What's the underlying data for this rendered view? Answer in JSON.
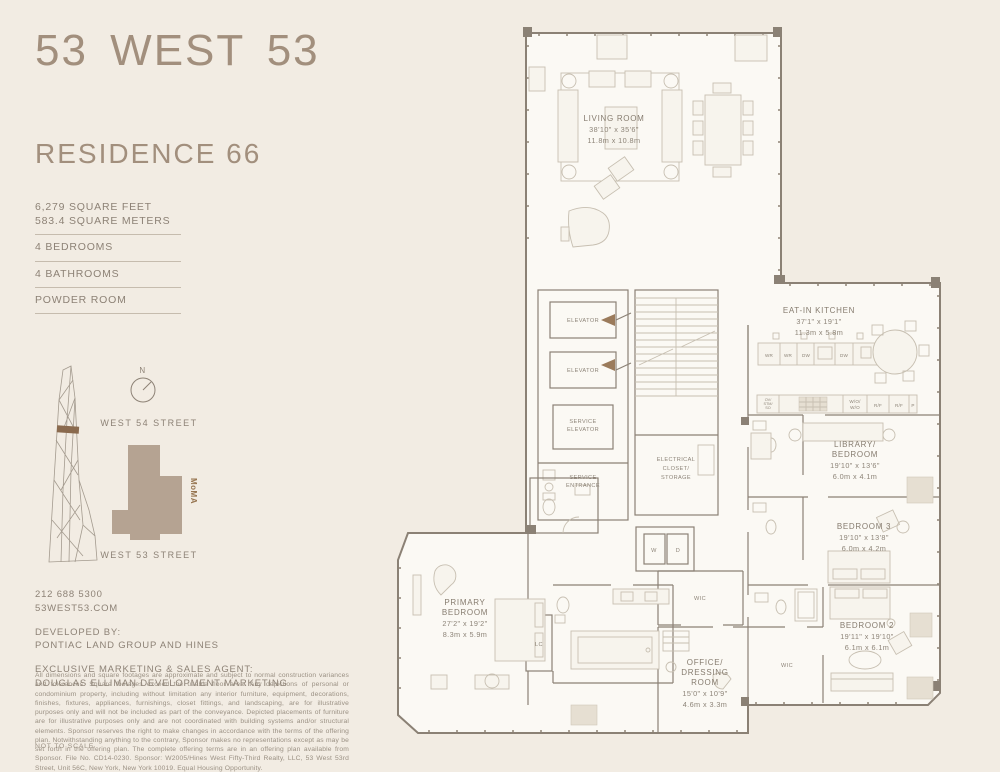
{
  "header": {
    "logo": "53 WEST 53",
    "residence": "RESIDENCE 66"
  },
  "facts": {
    "area_ft": "6,279 SQUARE FEET",
    "area_m": "583.4 SQUARE METERS",
    "bedrooms": "4 BEDROOMS",
    "bathrooms": "4 BATHROOMS",
    "powder": "POWDER ROOM"
  },
  "map": {
    "north": "N",
    "street_top": "WEST 54 STREET",
    "street_bottom": "WEST 53 STREET",
    "landmark": "MoMA"
  },
  "contact": {
    "phone": "212 688 5300",
    "website": "53WEST53.COM",
    "developed_by_label": "DEVELOPED BY:",
    "developer": "PONTIAC LAND GROUP AND HINES",
    "agent_label": "EXCLUSIVE MARKETING & SALES AGENT:",
    "agent": "DOUGLAS ELLIMAN DEVELOPMENT MARKETING"
  },
  "legal": {
    "disclaimer": "All dimensions and square footages are approximate and subject to normal construction variances and tolerances. Square footages exceed the usable floor area. Any depictions of personal or condominium property, including without limitation any interior furniture, equipment, decorations, finishes, fixtures, appliances, furnishings, closet fittings, and landscaping, are for illustrative purposes only and will not be included as part of the conveyance. Depicted placements of furniture are for illustrative purposes only and are not coordinated with building systems and/or structural elements. Sponsor reserves the right to make changes in accordance with the terms of the offering plan. Notwithstanding anything to the contrary, Sponsor makes no representations except as may be set forth in the offering plan. The complete offering terms are in an offering plan available from Sponsor. File No. CD14-0230. Sponsor: W2005/Hines West Fifty-Third Realty, LLC, 53 West 53rd Street, Unit 56C, New York, New York 10019. Equal Housing Opportunity.",
    "not_to_scale": "NOT TO SCALE"
  },
  "plan": {
    "rooms": {
      "living": {
        "name": "LIVING ROOM",
        "dim_ft": "38'10\" x 35'6\"",
        "dim_m": "11.8m x 10.8m"
      },
      "kitchen": {
        "name": "EAT-IN KITCHEN",
        "dim_ft": "37'1\" x 19'1\"",
        "dim_m": "11.3m x 5.8m"
      },
      "library": {
        "name1": "LIBRARY/",
        "name2": "BEDROOM",
        "dim_ft": "19'10\" x 13'6\"",
        "dim_m": "6.0m x 4.1m"
      },
      "bedroom3": {
        "name": "BEDROOM 3",
        "dim_ft": "19'10\" x 13'8\"",
        "dim_m": "6.0m x 4.2m"
      },
      "bedroom2": {
        "name": "BEDROOM 2",
        "dim_ft": "19'11\" x 19'10\"",
        "dim_m": "6.1m x 6.1m"
      },
      "primary": {
        "name1": "PRIMARY",
        "name2": "BEDROOM",
        "dim_ft": "27'2\" x 19'2\"",
        "dim_m": "8.3m x 5.9m"
      },
      "office": {
        "name1": "OFFICE/",
        "name2": "DRESSING",
        "name3": "ROOM",
        "dim_ft": "15'0\" x 10'9\"",
        "dim_m": "4.6m x 3.3m"
      }
    },
    "labels": {
      "elevator": "ELEVATOR",
      "service": "SERVICE",
      "entrance": "ENTRANCE",
      "elec1": "ELECTRICAL",
      "elec2": "CLOSET/",
      "elec3": "STORAGE",
      "washer": "W",
      "dryer": "D",
      "wic": "WIC",
      "lc": "LC",
      "wr": "WR",
      "dw": "DW",
      "ov1": "OV/",
      "ov2": "STM/",
      "ov3": "SO",
      "wo1": "W/O/",
      "wo2": "W/O",
      "rf": "R/F",
      "p": "P"
    }
  },
  "colors": {
    "background": "#f2ece3",
    "brand": "#a28f7d",
    "footprint": "#b5a392",
    "entry_arrow": "#9b7b5b"
  }
}
